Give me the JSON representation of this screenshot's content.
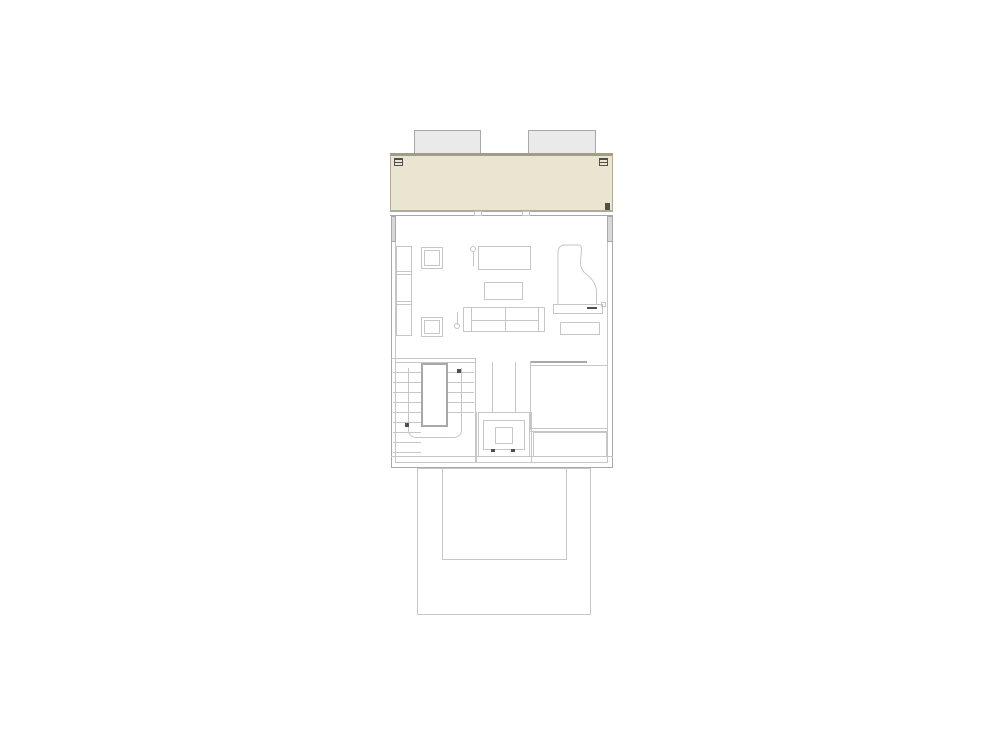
{
  "title": "",
  "text_labels": [],
  "colors": {
    "background": "#ffffff",
    "line_light": "#c6c6c6",
    "line_mid": "#a8a8a8",
    "line_dark": "#4f4f4f",
    "wall_fill": "#d8d8d8",
    "terrace_fill": "#eae5d1",
    "terrace_border": "#aeab96",
    "terrace_edge": "#a19d86",
    "skylight_fill": "#eaeaea"
  },
  "plan": {
    "type": "architectural-floor-plan",
    "symbols": [
      "skylight-left",
      "skylight-right",
      "roof-terrace",
      "terrace-vent-left",
      "terrace-vent-right",
      "living-room",
      "wall-shelf",
      "side-table-upper",
      "side-table-lower",
      "sideboard",
      "floor-lamp-by-sideboard",
      "coffee-table",
      "sofa",
      "floor-lamp-by-sofa",
      "grand-piano",
      "piano-bench",
      "staircase",
      "stair-void",
      "stair-walk-line",
      "chimney-shaft",
      "fireplace",
      "room-lower-right",
      "closet-strip",
      "lower-terrace"
    ]
  }
}
